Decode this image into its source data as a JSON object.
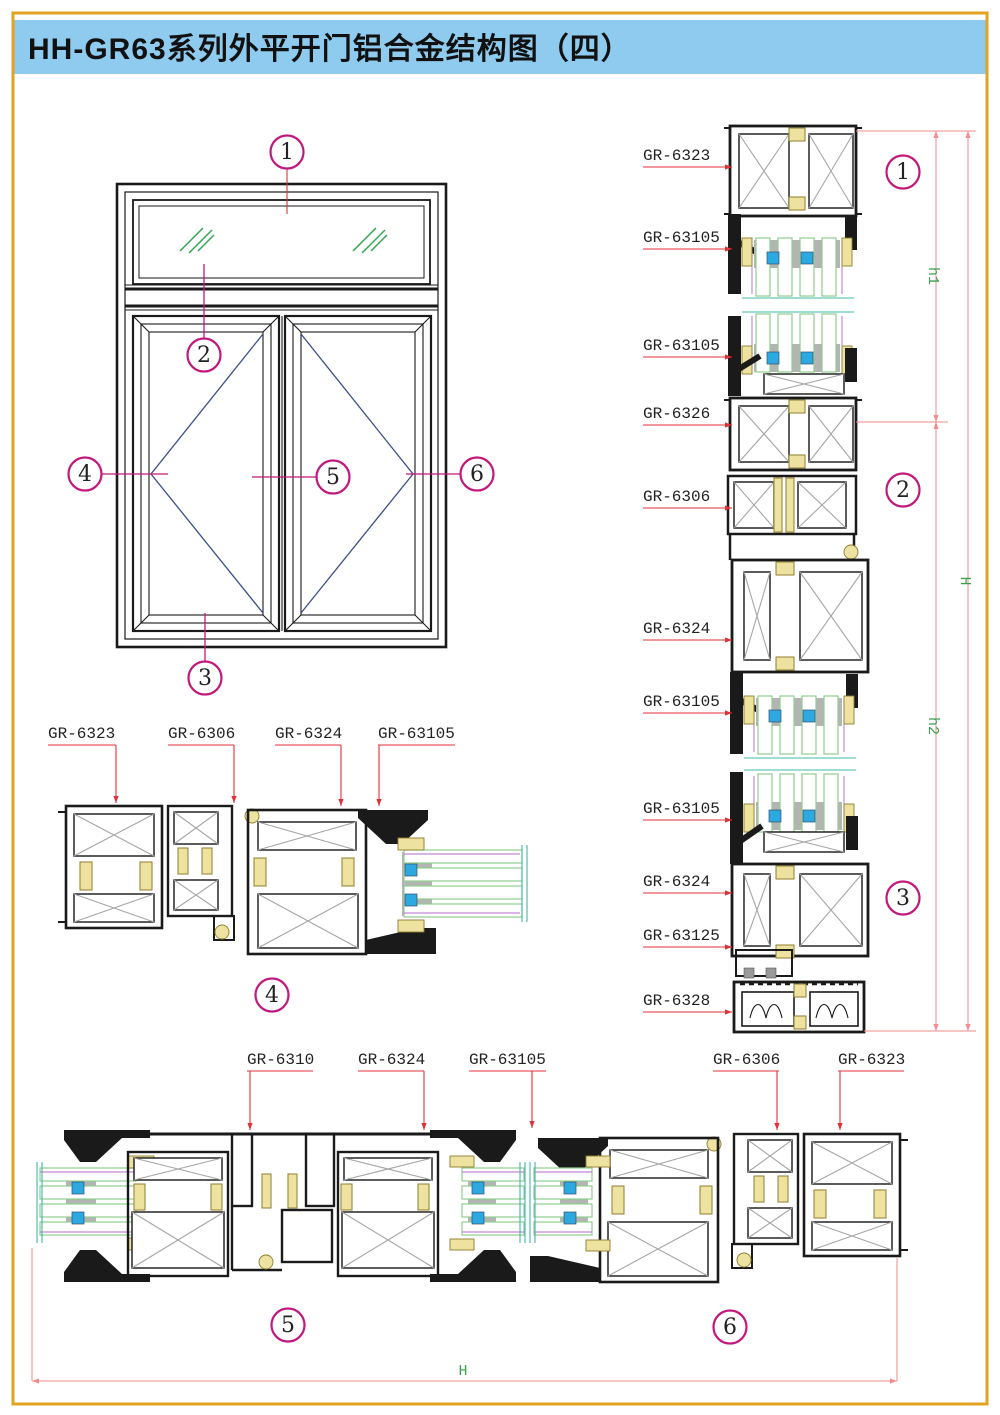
{
  "header": {
    "title": "HH-GR63系列外平开门铝合金结构图（四）"
  },
  "callouts": {
    "n1": "1",
    "n2": "2",
    "n3": "3",
    "n4": "4",
    "n5": "5",
    "n6": "6"
  },
  "labels": {
    "right": [
      "GR-6323",
      "GR-63105",
      "GR-63105",
      "GR-6326",
      "GR-6306",
      "GR-6324",
      "GR-63105",
      "GR-63105",
      "GR-6324",
      "GR-63125",
      "GR-6328"
    ],
    "d4": [
      "GR-6323",
      "GR-6306",
      "GR-6324",
      "GR-63105"
    ],
    "d5": [
      "GR-6310",
      "GR-6324",
      "GR-63105"
    ],
    "d6": [
      "GR-6306",
      "GR-6323"
    ]
  },
  "dims": {
    "h1": "h1",
    "h2": "h2",
    "H": "H",
    "bottom_h": "H"
  },
  "colors": {
    "header_blue": "#8ecbee",
    "border_amber": "#e2a321",
    "callout_magenta": "#c2177c",
    "leader_red": "#e03038",
    "dim_pink": "#f28b8b",
    "dim_text_green": "#3da050",
    "glass_green": "#8fce8f",
    "spacer_blue": "#2ca9e1",
    "connector_tan": "#ede2a0"
  }
}
